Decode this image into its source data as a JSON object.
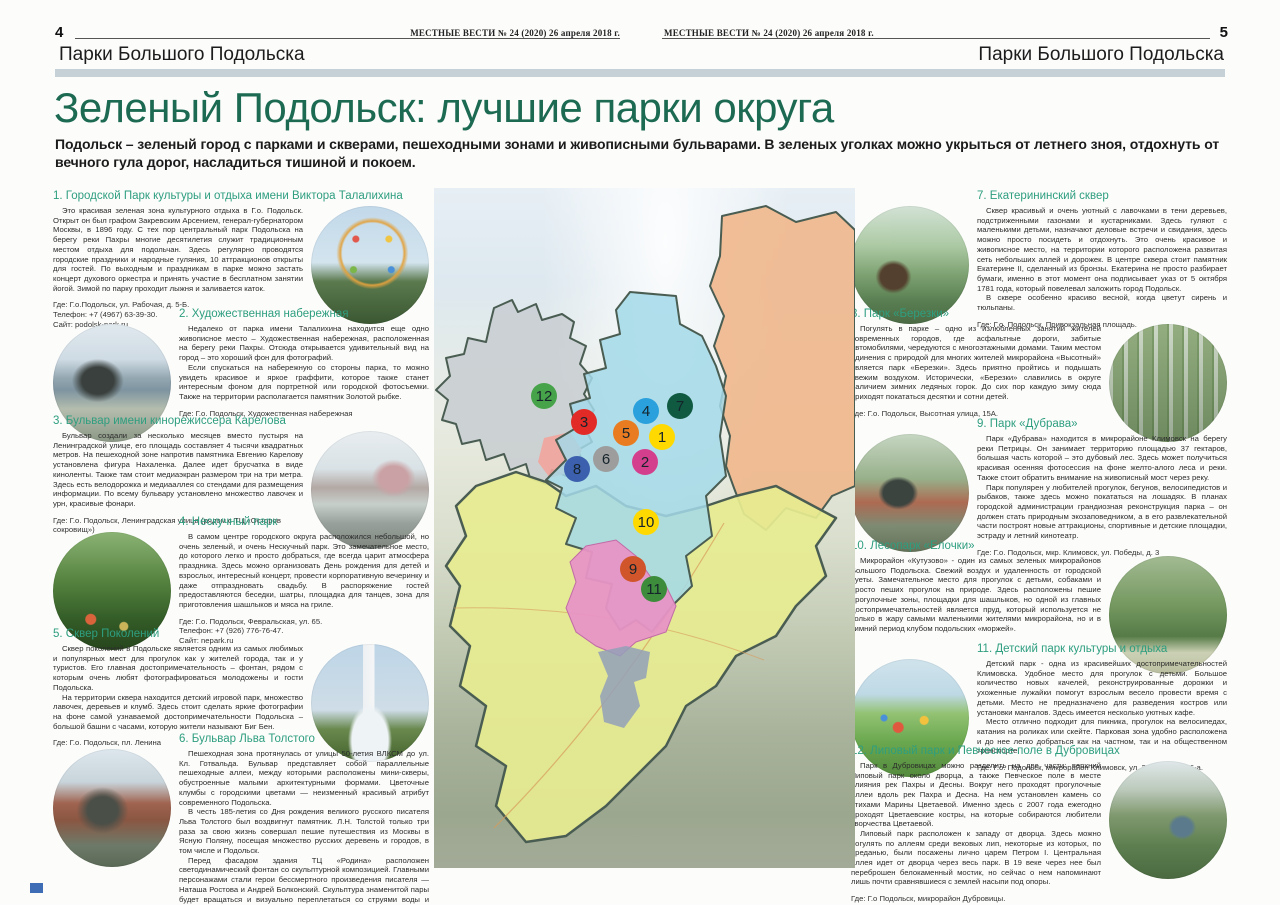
{
  "page_left": {
    "page_number": "4",
    "masthead": "МЕСТНЫЕ ВЕСТИ № 24 (2020) 26 апреля 2018 г.",
    "kicker": "Парки Большого Подольска"
  },
  "page_right": {
    "page_number": "5",
    "masthead": "МЕСТНЫЕ ВЕСТИ № 24 (2020) 26 апреля 2018 г.",
    "kicker": "Парки Большого Подольска"
  },
  "article": {
    "title": "Зеленый Подольск: лучшие парки округа",
    "lede": "Подольск – зеленый город с парками и скверами, пешеходными зонами и живописными бульварами. В зеленых уголках можно укрыться от летнего зноя, отдохнуть от вечного гула дорог, насладиться тишиной и покоем."
  },
  "sections": [
    {
      "num": "1",
      "title": "1. Городской Парк культуры и отдыха имени Виктора Талалихина",
      "photo": "ferris-wheel",
      "paragraphs": [
        "Это красивая зеленая зона культурного отдыха в Г.о. Подольск. Открыт он был графом Закревским Арсением, генерал-губернатором Москвы, в 1896 году. С тех пор центральный парк Подольска на берегу реки Пахры многие десятилетия служит традиционным местом отдыха для подольчан. Здесь регулярно проводятся городские праздники и народные гуляния, 10 аттракционов открыты для гостей. По выходным и праздникам в парке можно застать концерт духового оркестра и принять участие в бесплатном занятии йогой. Зимой по парку проходит лыжня и заливается каток."
      ],
      "where": [
        "Где: Г.о.Подольск, ул. Рабочая, д. 5-Б.",
        "Телефон: +7 (4967) 63-39-30.",
        "Сайт: podolsk-park.ru"
      ]
    },
    {
      "num": "2",
      "title": "2. Художественная набережная",
      "photo": "embankment-sculpture",
      "paragraphs": [
        "Недалеко от парка имени Талалихина находится еще одно живописное место – Художественная набережная, расположенная на берегу реки Пахры. Отсюда открывается удивительный вид на город – это хороший фон для фотографий.",
        "Если спускаться на набережную со стороны парка, то можно увидеть красивое и яркое граффити, которое также станет интересным фоном для портретной или городской фотосъемки. Также на территории располагается памятник Золотой рыбке."
      ],
      "where": [
        "Где: Г.о. Подольск, Художественная набережная"
      ]
    },
    {
      "num": "3",
      "title": "3. Бульвар имени кинорежиссера Карелова",
      "photo": "boulevard-street",
      "paragraphs": [
        "Бульвар создали за несколько месяцев вместо пустыря на Ленинградской улице, его площадь составляет 4 тысячи квадратных метров. На пешеходной зоне напротив памятника Евгению Карелову установлена фигура Нахаленка. Далее идет брусчатка в виде киноленты. Также там стоит медиаэкран размером три на три метра. Здесь есть велодорожка и медиааллея со стендами для размещения информации. По всему бульвару установлено множество лавочек и урн, красивые фонари."
      ],
      "where": [
        "Где: Г.о. Подольск, Ленинградская улица (рядом с ТЦ «Осторов сокровищ»)"
      ]
    },
    {
      "num": "4",
      "title": "4. Нескучный парк",
      "photo": "green-park-tents",
      "paragraphs": [
        "В самом центре городского округа расположился небольшой, но очень зеленый, и очень Нескучный парк. Это замечательное место, до которого легко и просто добраться, где всегда царит атмосфера праздника. Здесь можно организовать День рождения для детей и взрослых, интересный концерт, провести корпоративную вечеринку и даже отпраздновать свадьбу. В распоряжение гостей предоставляются беседки, шатры, площадка для танцев, зона для приготовления шашлыков и мяса на гриле."
      ],
      "where": [
        "Где: Г.о. Подольск, Февральская, ул. 65.",
        "Телефон: +7 (926) 776-76-47.",
        "Сайт: nepark.ru"
      ]
    },
    {
      "num": "5",
      "title": "5. Сквер Поколений",
      "photo": "clock-tower-fountain",
      "paragraphs": [
        "Сквер поколений в Подольске является одним из самых любимых и популярных мест для прогулок как у жителей города, так и у туристов. Его главная достопримечательность – фонтан, рядом с которым очень любят фотографироваться молодожены и гости Подольска.",
        "На территории сквера находится детский игровой парк, множество лавочек, деревьев и клумб. Здесь стоит сделать яркие фотографии на фоне самой узнаваемой достопримечательности Подольска – большой башни с часами, которую жители называют Биг Бен."
      ],
      "where": [
        "Где: Г.о. Подольск, пл. Ленина"
      ]
    },
    {
      "num": "6",
      "title": "6. Бульвар Льва Толстого",
      "photo": "tolstoy-monument",
      "paragraphs": [
        "Пешеходная зона протянулась от улицы 50-летия ВЛКСМ до ул. Кл. Готвальда. Бульвар представляет собой параллельные пешеходные аллеи, между которыми расположены мини-скверы, обустроенные малыми архитектурными формами. Цветочные клумбы с городскими цветами — неизменный красивый атрибут современного Подольска.",
        "В честь 185-летия со Дня рождения великого русского писателя Льва Толстого был воздвигнут памятник. Л.Н. Толстой только три раза за свою жизнь совершал пешие путешествия из Москвы в Ясную Поляну, посещая множество русских деревень и городов, в том числе и Подольск.",
        "Перед фасадом здания ТЦ «Родина» расположен светодинамический фонтан со скульптурной композицией. Главными персонажами стали герои бессмертного произведения писателя — Наташа Ростова и Андрей Болконский. Скульптура знаменитой пары будет вращаться и визуально переплетаться со струями воды и света, создавая эффект танца на первом балу Наташи Ростовой."
      ],
      "where": [
        "Где: Г.о.Подольск, ул. Кирова."
      ]
    },
    {
      "num": "7",
      "title": "7. Екатерининский сквер",
      "photo": "catherine-monument",
      "paragraphs": [
        "Сквер красивый и очень уютный с лавочками в тени деревьев, подстриженными газонами и кустарниками. Здесь гуляют с маленькими детьми, назначают деловые встречи и свидания, здесь можно просто посидеть и отдохнуть. Это очень красивое и живописное место, на территории которого расположена развитая сеть небольших аллей и дорожек. В центре сквера стоит памятник Екатерине II, сделанный из бронзы. Екатерина не просто разбирает бумаги, именно в этот момент она подписывает указ от 5 октября 1781 года, который повелевал заложить город Подольск.",
        "В сквере особенно красиво весной, когда цветут сирень и тюльпаны."
      ],
      "where": [
        "Где: Г.о. Подольск, Привокзальная площадь."
      ]
    },
    {
      "num": "8",
      "title": "8. Парк «Березки»",
      "photo": "birch-forest",
      "paragraphs": [
        "Погулять в парке – одно из излюбленных занятий жителей современных городов, где асфальтные дороги, забитые автомобилями, чередуются с многоэтажными домами. Таким местом единения с природой для многих жителей микрорайона «Высотный» является парк «Березки». Здесь приятно пройтись и подышать свежим воздухом. Исторически, «Березки» славились в округе наличием зимних ледяных горок. До сих пор каждую зиму сюда приходят покататься десятки и сотни детей."
      ],
      "where": [
        "Где: Г.о. Подольск, Высотная улица, 15А."
      ]
    },
    {
      "num": "9",
      "title": "9. Парк «Дубрава»",
      "photo": "dubrava-statue",
      "paragraphs": [
        "Парк «Дубрава» находится в микрорайоне Климовск на берегу реки Петрицы. Он занимает территорию площадью 37 гектаров, большая часть которой – это дубовый лес. Здесь может получиться красивая осенняя фотосессия на фоне желто-алого леса и реки. Также стоит обратить внимание на живописный мост через реку.",
        "Парк популярен у любителей прогулок, бегунов, велосипедистов и рыбаков, также здесь можно покататься на лошадях. В планах городской администрации грандиозная реконструкция парка – он должен стать природным экозаповедником, а в его развлекательной части построят новые аттракционы, спортивные и детские площадки, эстраду и летний кинотеатр."
      ],
      "where": [
        "Где: Г.о. Подольск, мкр. Климовск, ул. Победы, д. 3"
      ]
    },
    {
      "num": "10",
      "title": "10. Лесопарк «Елочки»",
      "photo": "forest-path",
      "paragraphs": [
        "Микрорайон «Кутузово» - один из самых зеленых микрорайонов Большого Подольска. Свежий воздух и удаленность от городской суеты. Замечательное место для прогулок с детьми, собаками и просто пеших прогулок на природе. Здесь расположены пешие прогулочные зоны, площадки для шашлыков, но одной из главных достопримечательностей является пруд, который используется не только в жару самыми маленькими жителями микрорайона, но и в зимний период клубом подольских «моржей»."
      ],
      "where": []
    },
    {
      "num": "11",
      "title": "11. Детский парк культуры и отдыха",
      "photo": "playground",
      "paragraphs": [
        "Детский парк - одна из красивейших достопримечательностей Климовска. Удобное место для прогулок с детьми. Большое количество новых качелей, реконструированные дорожки и ухоженные лужайки помогут взрослым весело провести время с детьми. Место не предназначено для разведения костров или установки мангалов. Здесь имеется несколько уютных кафе.",
        "Место отлично подходит для пикника, прогулок на велосипедах, катания на роликах или скейте. Парковая зона удобно расположена и до нее легко добраться как на частном, так и на общественном транспорте."
      ],
      "where": [
        "Где: Г.о. Подольск, микрорайон Климовск, ул. Заводская, д.6-а."
      ]
    },
    {
      "num": "12",
      "title": "12. Липовый парк и Певческое поле в Дубровицах",
      "photo": "aerial-river-park",
      "paragraphs": [
        "Парк в Дубровицах можно разделить на две части: верхний Липовый парк около дворца, а также Певческое поле в месте слияния рек Пахры и Десны. Вокруг него проходят прогулочные аллеи вдоль рек Пахра и Десна. На нем установлен камень со стихами Марины Цветаевой. Именно здесь с 2007 года ежегодно проходят Цветаевские костры, на которые собираются любители творчества Цветаевой.",
        "Липовый парк расположен к западу от дворца. Здесь можно погулять по аллеям среди вековых лип, некоторые из которых, по преданью, были посажены лично царем Петром I. Центральная аллея идет от дворца через весь парк. В 19 веке через нее был переброшен белокаменный мостик, но сейчас о нем напоминают лишь почти сравнявшиеся с землей насыпи под опоры."
      ],
      "where": [
        "Где: Г.о Подольск, микрорайон Дубровицы."
      ]
    }
  ],
  "map": {
    "markers": [
      {
        "n": "1",
        "color": "#ffd900",
        "x": 228,
        "y": 249
      },
      {
        "n": "2",
        "color": "#d43f8d",
        "x": 211,
        "y": 274
      },
      {
        "n": "3",
        "color": "#e22b26",
        "x": 150,
        "y": 234
      },
      {
        "n": "4",
        "color": "#2aa0dc",
        "x": 212,
        "y": 223
      },
      {
        "n": "5",
        "color": "#e97c20",
        "x": 192,
        "y": 245
      },
      {
        "n": "6",
        "color": "#9d9d9d",
        "x": 172,
        "y": 271
      },
      {
        "n": "7",
        "color": "#0f5a41",
        "x": 246,
        "y": 218
      },
      {
        "n": "8",
        "color": "#3c60ae",
        "x": 143,
        "y": 281
      },
      {
        "n": "9",
        "color": "#d0552b",
        "x": 199,
        "y": 381
      },
      {
        "n": "10",
        "color": "#ffd900",
        "x": 212,
        "y": 334
      },
      {
        "n": "11",
        "color": "#3c8c3c",
        "x": 220,
        "y": 401
      },
      {
        "n": "12",
        "color": "#47a349",
        "x": 110,
        "y": 208
      }
    ]
  },
  "colors": {
    "title_green": "#1d6a52",
    "heading_teal": "#2e9e7f",
    "header_bar": "#c6d0d7",
    "corner_mark": "#3f6db5"
  }
}
